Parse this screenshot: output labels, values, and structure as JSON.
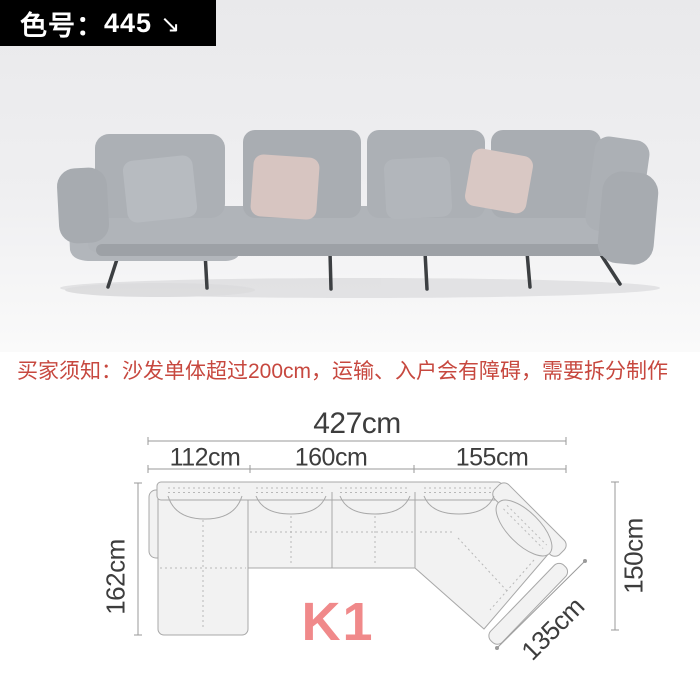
{
  "badge": {
    "label": "色号：",
    "value": "445",
    "arrow_icon": "↘",
    "bg_color": "#000000",
    "text_color": "#ffffff"
  },
  "photo": {
    "colors": {
      "background": "#e9e9eb",
      "sofa_gray": "#abafb4",
      "pillow_blush": "#d7c5c1",
      "legs": "#3c3f42"
    }
  },
  "notice": {
    "text": "买家须知：沙发单体超过200cm，运输、入户会有障碍，需要拆分制作",
    "color": "#c7483f"
  },
  "diagram": {
    "model_label": "K1",
    "model_color": "#f0898a",
    "line_color": "#9a9a9a",
    "dimensions": {
      "total_width": "427cm",
      "segments": [
        "112cm",
        "160cm",
        "155cm"
      ],
      "left_depth": "162cm",
      "right_depth": "150cm",
      "diagonal_width": "135cm"
    }
  }
}
